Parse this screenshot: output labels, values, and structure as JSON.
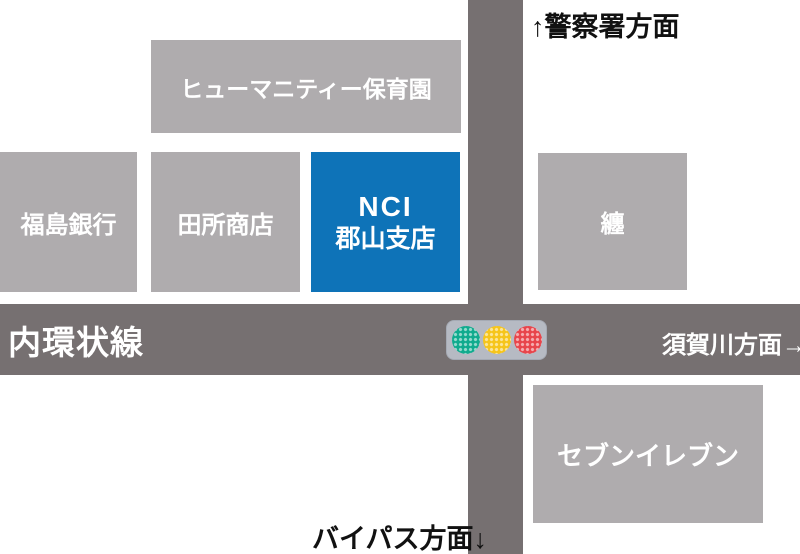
{
  "colors": {
    "background": "#ffffff",
    "road": "#767071",
    "building": "#afacae",
    "accent-blue": "#0e73b8",
    "label-dark": "#111111",
    "label-light": "#ffffff",
    "signal-housing": "#b6bac3",
    "signal-green": "#10ab8e",
    "signal-yellow": "#f6c51b",
    "signal-red": "#e8454b"
  },
  "roads": {
    "horizontal_label": "内環状線"
  },
  "buildings": {
    "nursery": "ヒューマニティー保育園",
    "fukushima_bank": "福島銀行",
    "tadokoro_shoten": "田所商店",
    "nci_line1": "NCI",
    "nci_line2": "郡山支店",
    "matoi": "纏",
    "seven_eleven": "セブンイレブン"
  },
  "directions": {
    "north": "↑警察署方面",
    "east": "須賀川方面→",
    "south": "バイパス方面↓"
  },
  "traffic_light": {
    "lights": [
      "green",
      "yellow",
      "red"
    ]
  }
}
